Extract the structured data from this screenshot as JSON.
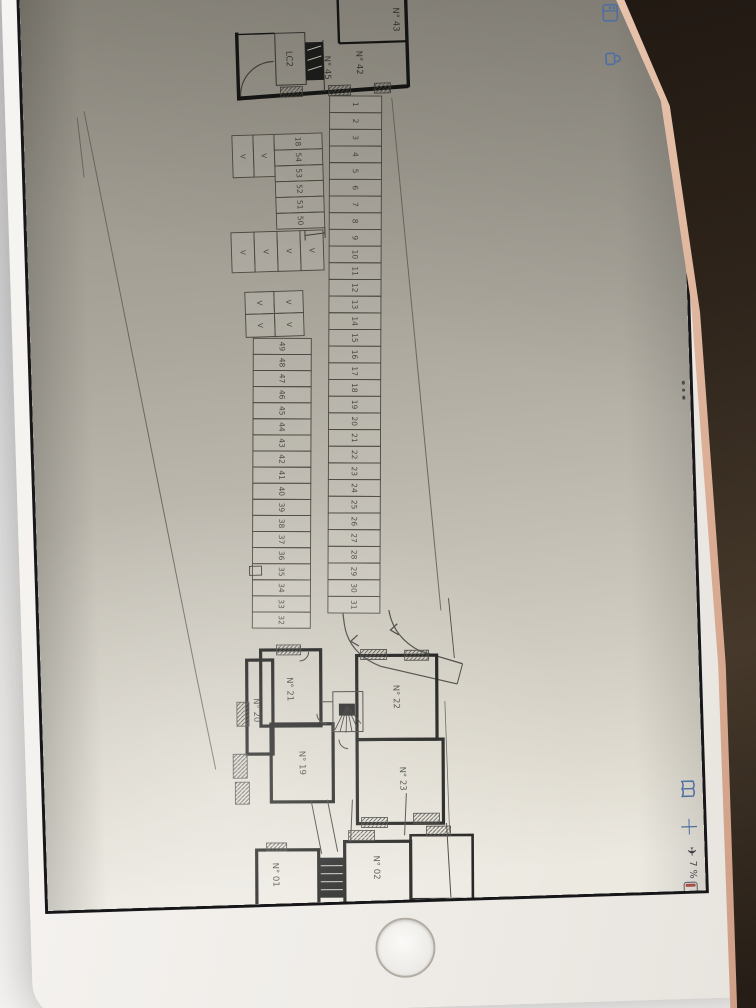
{
  "status": {
    "time_date": "7:55 Mercredi 11 décembre",
    "airplane_glyph": "✈",
    "battery_percent": "7 %",
    "battery_level": "7"
  },
  "toolbar": {
    "accent_color": "#4f6fa0",
    "more_glyph": "•••",
    "add_glyph": "+",
    "icons": [
      "thumbnails",
      "lock",
      "more",
      "book",
      "add"
    ]
  },
  "plan": {
    "main_row": [
      "1",
      "2",
      "3",
      "4",
      "5",
      "6",
      "7",
      "8",
      "9",
      "10",
      "11",
      "12",
      "13",
      "14",
      "15",
      "16",
      "17",
      "18",
      "19",
      "20",
      "21",
      "22",
      "23",
      "24",
      "25",
      "26",
      "27",
      "28",
      "29",
      "30",
      "31"
    ],
    "lower_row": [
      "49",
      "48",
      "47",
      "46",
      "45",
      "44",
      "43",
      "42",
      "41",
      "40",
      "39",
      "38",
      "37",
      "36",
      "35",
      "34",
      "33",
      "32"
    ],
    "cluster": [
      "18",
      "54",
      "53",
      "52",
      "51",
      "50"
    ],
    "v_pair": [
      "V",
      "V"
    ],
    "v_row": [
      "V",
      "V",
      "V",
      "V"
    ],
    "v_grid": [
      "V",
      "V",
      "V",
      "V"
    ],
    "upper_rooms": [
      {
        "id": "room-43",
        "label": "N° 43"
      },
      {
        "id": "room-42",
        "label": "N° 42"
      },
      {
        "id": "room-45",
        "label": "N° 45"
      },
      {
        "id": "room-lc2",
        "label": "LC2"
      }
    ],
    "lower_rooms": [
      {
        "id": "room-21",
        "label": "N° 21"
      },
      {
        "id": "room-20",
        "label": "N° 20"
      },
      {
        "id": "room-19",
        "label": "N° 19"
      },
      {
        "id": "room-22",
        "label": "N° 22"
      },
      {
        "id": "room-23",
        "label": "N° 23"
      }
    ],
    "basement_rooms": [
      {
        "id": "room-01",
        "label": "N° 01"
      },
      {
        "id": "room-02",
        "label": "N° 02"
      }
    ]
  },
  "colors": {
    "paper_dark": "#8d897f",
    "paper_light": "#ece9e1",
    "wall": "#161614",
    "line": "#4a4840",
    "background_dark": "#2e241b",
    "bezel": "#f4f2ef"
  }
}
